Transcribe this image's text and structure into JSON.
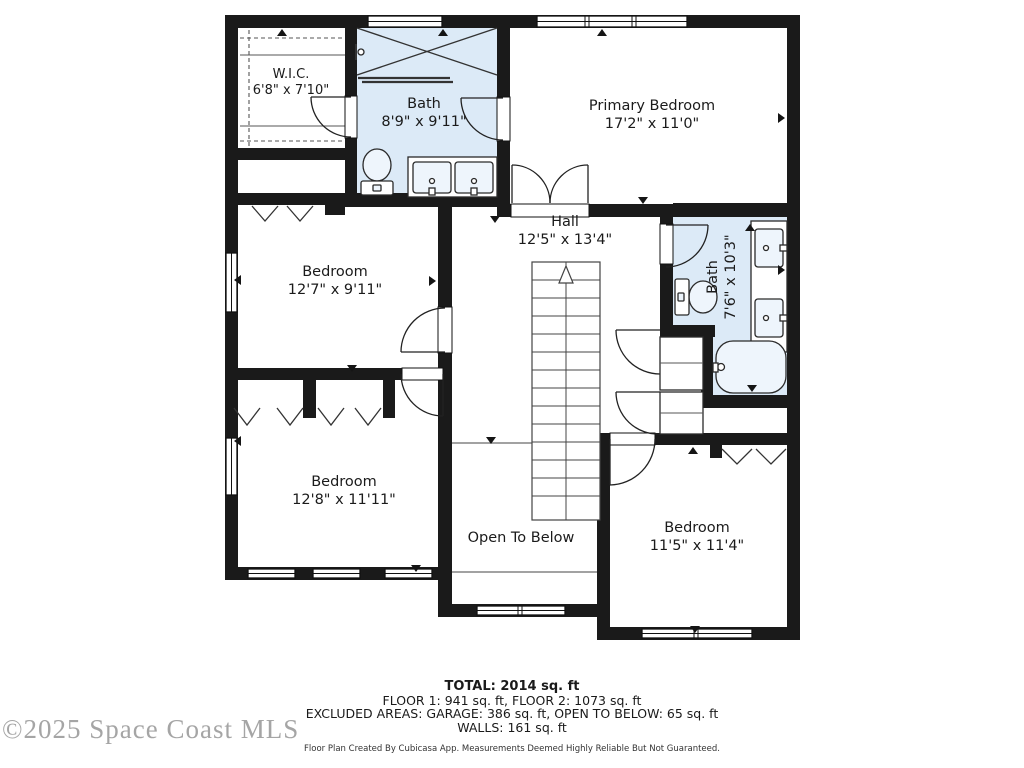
{
  "plan": {
    "rooms": [
      {
        "name": "W.I.C.",
        "dims": "6'8\" x 7'10\""
      },
      {
        "name": "Bath",
        "dims": "8'9\" x 9'11\""
      },
      {
        "name": "Primary Bedroom",
        "dims": "17'2\" x 11'0\""
      },
      {
        "name": "Hall",
        "dims": "12'5\" x 13'4\""
      },
      {
        "name": "Bedroom",
        "dims": "12'7\" x 9'11\""
      },
      {
        "name": "Bath",
        "dims": "7'6\" x 10'3\""
      },
      {
        "name": "Bedroom",
        "dims": "12'8\" x 11'11\""
      },
      {
        "name": "Open To Below",
        "dims": ""
      },
      {
        "name": "Bedroom",
        "dims": "11'5\" x 11'4\""
      }
    ],
    "colors": {
      "wall": "#1a1a1a",
      "wet_room_fill": "#dceaf7"
    }
  },
  "summary": {
    "total": "TOTAL: 2014 sq. ft",
    "floors": "FLOOR 1: 941 sq. ft, FLOOR 2: 1073 sq. ft",
    "excluded": "EXCLUDED AREAS: GARAGE: 386 sq. ft, OPEN TO BELOW: 65 sq. ft",
    "walls": "WALLS: 161 sq. ft",
    "disclaimer": "Floor Plan Created By Cubicasa App. Measurements Deemed Highly Reliable But Not Guaranteed."
  },
  "watermark": "©2025 Space Coast MLS"
}
